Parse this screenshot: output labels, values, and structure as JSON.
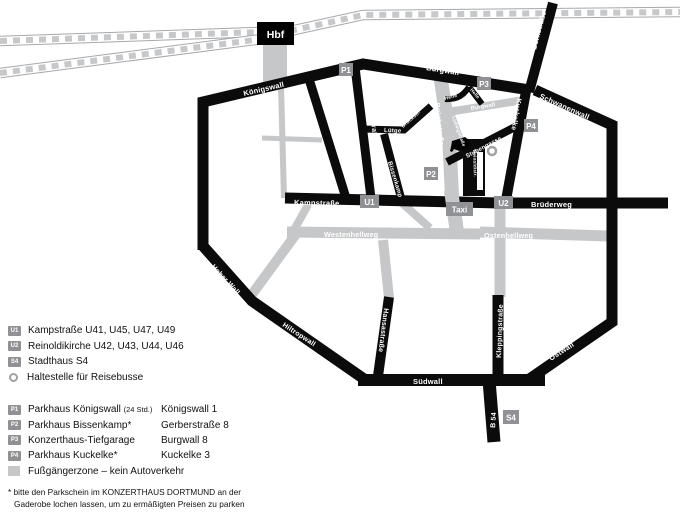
{
  "map": {
    "hbf_label": "Hbf",
    "labels": {
      "koenigswall": "Königswall",
      "burgwall": "Burgwall",
      "burgwall_gray": "Burgwall",
      "bornstrasse": "Bornstraße",
      "schwanenwall": "Schwanenwall",
      "kuckelke": "Kuckelke",
      "helle": "Helle",
      "helle2": "Helle",
      "brueckstrasse": "Brückstraße",
      "ludwigstrasse": "Ludwigstraße",
      "stubengasse": "Stubengasse",
      "reinoldistrasse": "Reinoldistr.",
      "luetge": "Lütge",
      "brueckstr_kurz": "Brückstr.",
      "freistuhl": "Freistuhl",
      "hansastrasse_nord": "Hansastraße",
      "hansastrasse_sued": "Hansastraße",
      "bissenkamp": "Bissenkamp",
      "kampstrasse": "Kampstraße",
      "bruederweg": "Brüderweg",
      "westenhellweg": "Westenhellweg",
      "ostenhellweg": "Ostenhellweg",
      "kleppingstrasse": "Kleppingstraße",
      "ostwall": "Ostwall",
      "suedwall": "Südwall",
      "b54": "B 54",
      "hiltropwall": "Hiltropwall",
      "hoher_wall": "Hoher Wall"
    },
    "badges": {
      "p1": "P1",
      "p2": "P2",
      "p3": "P3",
      "p4": "P4",
      "u1": "U1",
      "u2": "U2",
      "s4": "S4",
      "taxi": "Taxi"
    }
  },
  "legend": {
    "transit": [
      {
        "badge": "U1",
        "label": "Kampstraße U41, U45, U47, U49"
      },
      {
        "badge": "U2",
        "label": "Reinoldikirche U42, U43, U44, U46"
      },
      {
        "badge": "S4",
        "label": "Stadthaus S4"
      },
      {
        "label": "Haltestelle für Reisebusse"
      }
    ],
    "parking": [
      {
        "badge": "P1",
        "name": "Parkhaus Königswall",
        "note": "(24 Std.)",
        "address": "Königswall 1"
      },
      {
        "badge": "P2",
        "name": "Parkhaus Bissenkamp*",
        "note": "",
        "address": "Gerberstraße 8"
      },
      {
        "badge": "P3",
        "name": "Konzerthaus-Tiefgarage",
        "note": "",
        "address": "Burgwall 8"
      },
      {
        "badge": "P4",
        "name": "Parkhaus Kuckelke*",
        "note": "",
        "address": "Kuckelke 3"
      },
      {
        "name": "Fußgängerzone – kein Autoverkehr"
      }
    ],
    "footnote_line1": "* bitte den Parkschein im KONZERTHAUS DORTMUND an der",
    "footnote_line2": "Gaderobe lochen lassen, um zu ermäßigten Preisen zu parken"
  },
  "colors": {
    "street_black": "#0b0b0b",
    "pedestrian_gray": "#c6c7c9",
    "badge_gray": "#8f9194",
    "rail_outline": "#a6a8ab",
    "rail_dash": "#c7c8ca"
  }
}
